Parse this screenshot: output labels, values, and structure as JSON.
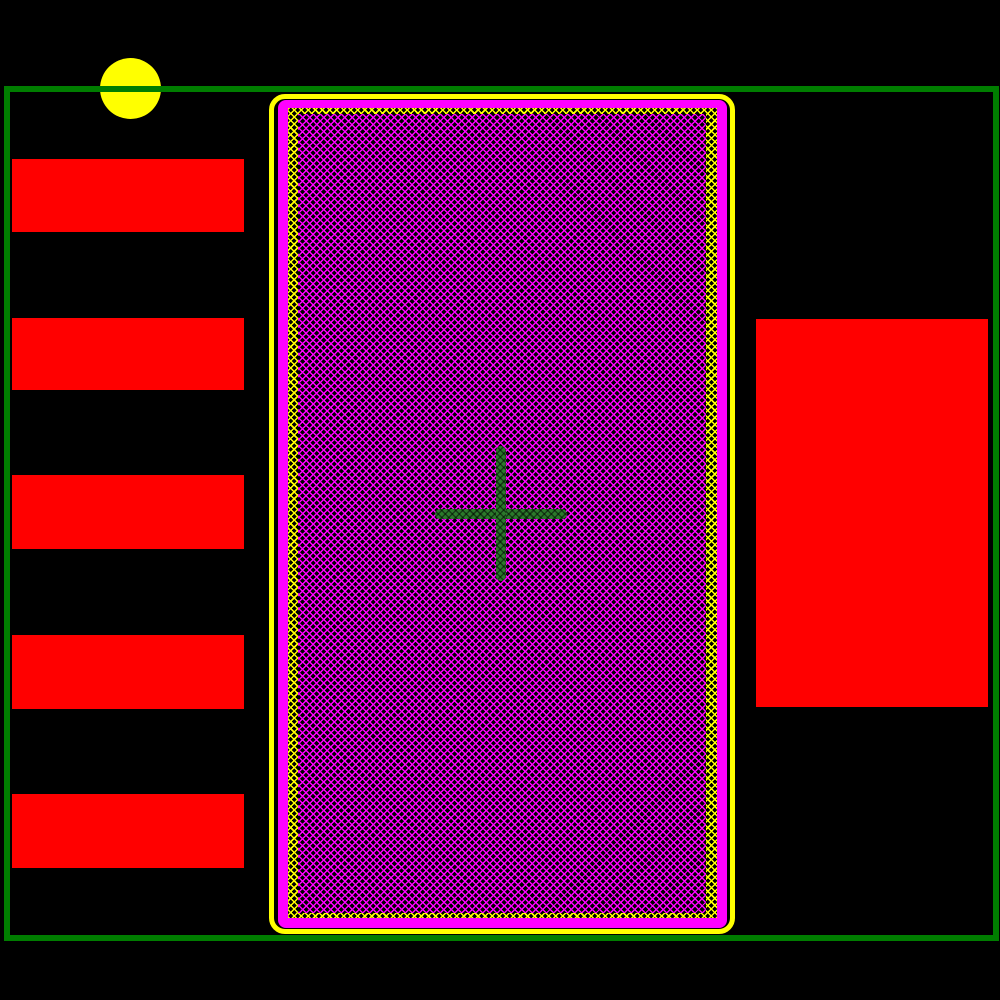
{
  "canvas": {
    "width": 1000,
    "height": 1000,
    "background": "#000000"
  },
  "colors": {
    "canvas_bg": "#000000",
    "courtyard": "#007D00",
    "pad": "#FF0000",
    "pad_border": "#FF00FF",
    "mask": "#FFFF00",
    "crosshair": "#2B7A2B",
    "hatch_bg": "#000000"
  },
  "courtyard": {
    "x": 4,
    "y": 86,
    "w": 995,
    "h": 855,
    "stroke": 6
  },
  "pin1_marker": {
    "x": 100,
    "y": 58,
    "w": 61,
    "h": 61
  },
  "left_pads": [
    {
      "x": 12,
      "y": 159,
      "w": 232,
      "h": 73
    },
    {
      "x": 12,
      "y": 318,
      "w": 232,
      "h": 72
    },
    {
      "x": 12,
      "y": 475,
      "w": 232,
      "h": 74
    },
    {
      "x": 12,
      "y": 635,
      "w": 232,
      "h": 74
    },
    {
      "x": 12,
      "y": 794,
      "w": 232,
      "h": 74
    }
  ],
  "right_pad": {
    "x": 756,
    "y": 319,
    "w": 232,
    "h": 388
  },
  "thermal_pad": {
    "outline": {
      "x": 269,
      "y": 94,
      "w": 466,
      "h": 840,
      "stroke": 5,
      "radius": 16
    },
    "solid": {
      "x": 278,
      "y": 100,
      "w": 449,
      "h": 828,
      "radius": 8
    },
    "mask_ring": {
      "x": 288,
      "y": 108,
      "w": 429,
      "h": 810
    },
    "fill": {
      "x": 298,
      "y": 114,
      "w": 408,
      "h": 799
    },
    "crosshair": {
      "h": {
        "x": 435,
        "y": 509,
        "w": 132,
        "h": 10
      },
      "v": {
        "x": 496,
        "y": 446,
        "w": 10,
        "h": 135
      }
    }
  }
}
